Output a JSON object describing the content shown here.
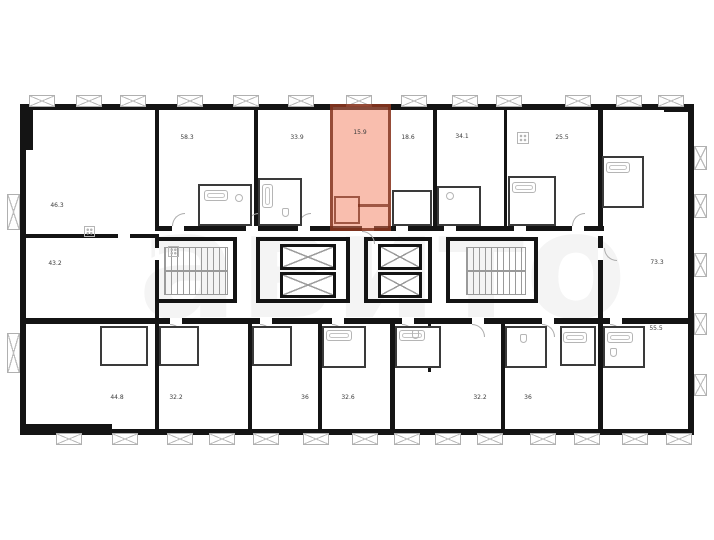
{
  "floorplan": {
    "watermark_text": "авито",
    "wall_color": "#141414",
    "highlight_fill": "#f37e5e",
    "highlight_wall": "#7a2b17",
    "fixture_color": "#b5b5b5",
    "label_color": "#3c3c3c",
    "units": [
      {
        "id": "top-1",
        "area": "58.3",
        "highlighted": false
      },
      {
        "id": "top-2",
        "area": "33.9",
        "highlighted": false
      },
      {
        "id": "top-3-selected",
        "area": "15.9",
        "highlighted": true
      },
      {
        "id": "top-4",
        "area": "18.6",
        "highlighted": false
      },
      {
        "id": "top-5",
        "area": "34.1",
        "highlighted": false
      },
      {
        "id": "top-6",
        "area": "25.5",
        "highlighted": false
      },
      {
        "id": "left-upper",
        "area": "46.3",
        "highlighted": false
      },
      {
        "id": "left-middle",
        "area": "43.2",
        "highlighted": false
      },
      {
        "id": "right-middle",
        "area": "73.3",
        "highlighted": false
      },
      {
        "id": "right-lower",
        "area": "55.5",
        "highlighted": false
      },
      {
        "id": "bottom-1",
        "area": "44.8",
        "highlighted": false
      },
      {
        "id": "bottom-2",
        "area": "32.2",
        "highlighted": false
      },
      {
        "id": "bottom-3",
        "area": "36",
        "highlighted": false
      },
      {
        "id": "bottom-4",
        "area": "32.6",
        "highlighted": false
      },
      {
        "id": "bottom-5",
        "area": "32.2",
        "highlighted": false
      },
      {
        "id": "bottom-6",
        "area": "36",
        "highlighted": false
      }
    ],
    "icons": {
      "window-icon": "rectangle with X cross",
      "door-swing-icon": "quarter arc",
      "stairs-icon": "tread hatch",
      "elevator-shaft-icon": "box with X cross",
      "bathtub-icon": "double rounded rectangle",
      "stove-icon": "square with four dots",
      "sink-icon": "circle",
      "toilet-icon": "small rounded rectangle"
    }
  }
}
